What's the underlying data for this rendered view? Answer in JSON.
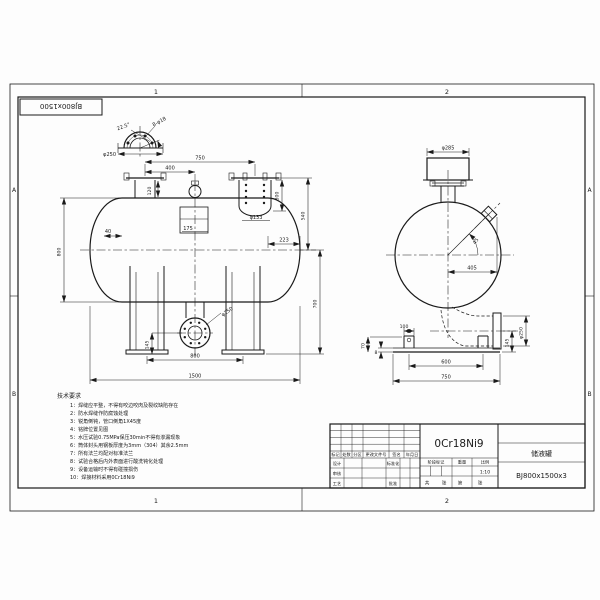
{
  "sheet": {
    "corner_stamp": "BJ800x1500",
    "zones": {
      "c1": "1",
      "c2": "2",
      "rA": "A",
      "rB": "B"
    }
  },
  "front": {
    "flange_detail": {
      "angle": "22.5°",
      "holes": "8-φ18",
      "dia": "φ250"
    },
    "dims": {
      "top_span": "750",
      "top_left": "400",
      "nozzle_h": "120",
      "dip_h": "300",
      "dip_dia": "φ133",
      "head_right": "223",
      "head_left": "40",
      "baffle": "175",
      "dia": "800",
      "flange_to_cl": "540",
      "cl_to_base": "700",
      "drain_dia": "φ250",
      "drain_h": "145",
      "saddle_span": "800",
      "length": "1500"
    }
  },
  "side": {
    "dims": {
      "cap_dia": "φ285",
      "angle": "45",
      "offset": "405",
      "foot_w": "100",
      "plate_t": "8",
      "base_h": "70",
      "foot_span": "600",
      "base_w": "750",
      "pipe_h": "145",
      "pipe_dia": "φ250"
    }
  },
  "notes": {
    "title": "技术要求",
    "items": [
      "1：焊缝应平整，不得有咬边咬肉及裂纹缺陷存在",
      "2：防水焊缝作防腐蚀处理",
      "3：锐角倒钝，管口倒角1X45度",
      "4：铭牌位置见图",
      "5：水压试验0.75MPa保压30min不得有渗漏现象",
      "6：筒体封头用钢板厚度为3mm（304）其余2.5mm",
      "7：所有法兰均配对标准法兰",
      "8：试验合格后内外表面进行酸洗钝化处理",
      "9：设备运输时不得有碰撞损伤",
      "10：焊接材料采用0Cr18Ni9"
    ]
  },
  "title_block": {
    "material": "0Cr18Ni9",
    "part_name": "储液罐",
    "drawing_no": "BJ800x1500x3",
    "scale_value": "1:10",
    "rev": {
      "mark": "标记",
      "count": "处数",
      "zone": "分区",
      "doc": "更改文件号",
      "sign": "签名",
      "date": "年月日"
    },
    "roles": {
      "design": "设计",
      "standard": "标准化",
      "check": "审核",
      "process": "工艺",
      "approve": "批准"
    },
    "headers": {
      "stage": "阶段标记",
      "weight": "重量",
      "scale": "比例"
    },
    "pages": {
      "total": "共",
      "sheet1": "张",
      "no": "第",
      "sheet2": "张"
    }
  }
}
